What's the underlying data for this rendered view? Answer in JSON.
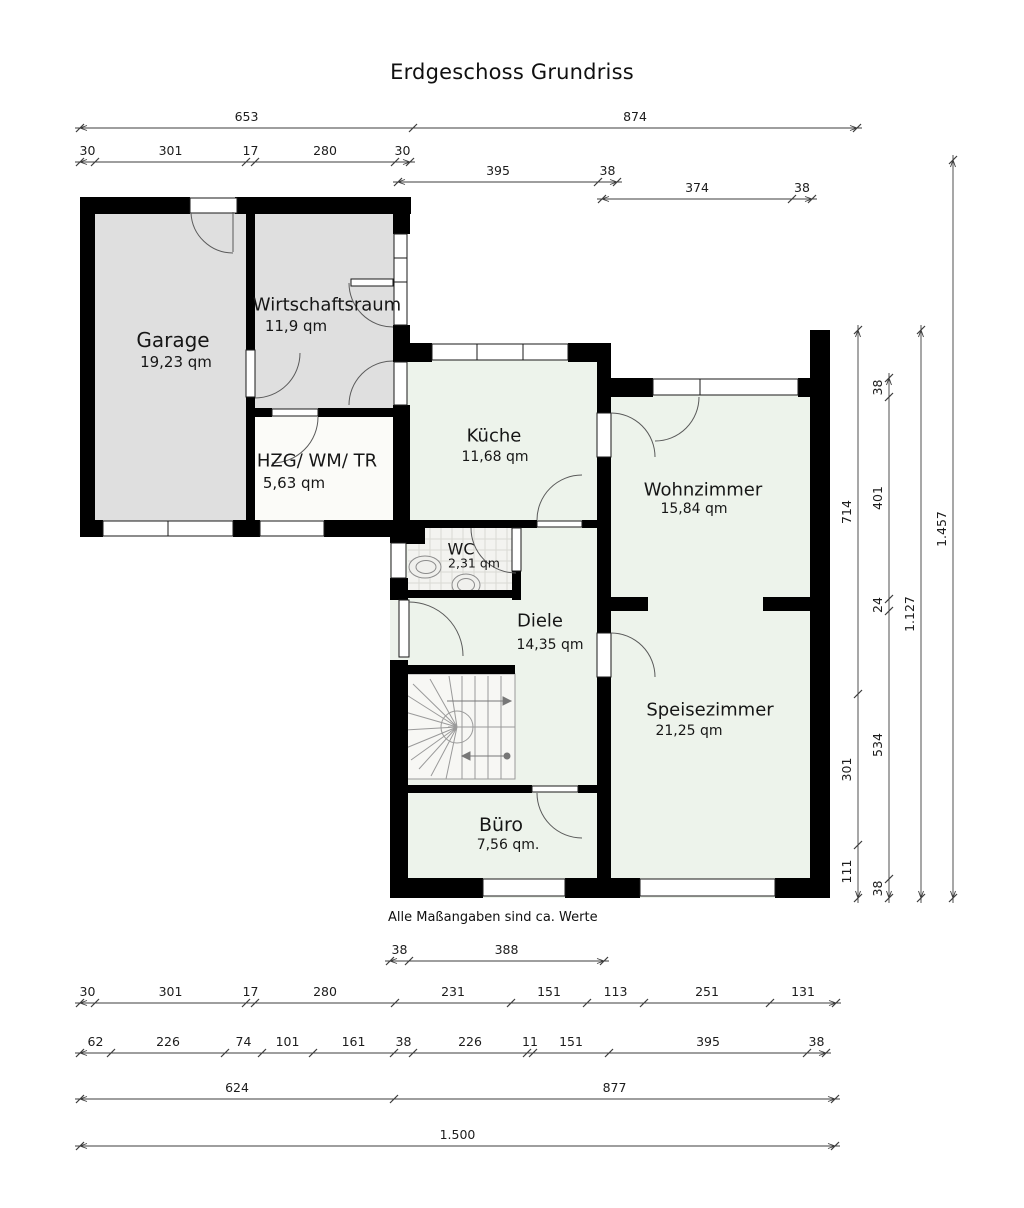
{
  "title": "Erdgeschoss Grundriss",
  "note": "Alle Maßangaben sind ca. Werte",
  "colors": {
    "wall": "#000000",
    "room_green": "#edf3eb",
    "room_gray": "#dfdfdf",
    "room_white": "#fbfbf8",
    "wc_tile": "#f3f3f0",
    "dim_line": "#3c3c3c",
    "text": "#161616"
  },
  "rooms": [
    {
      "id": "garage",
      "name": "Garage",
      "area": "19,23 qm",
      "cx": 173,
      "cy": 340,
      "acx": 176,
      "acy": 362,
      "nfs": 20,
      "afs": 15
    },
    {
      "id": "wirtschaftsraum",
      "name": "Wirtschaftsraum",
      "area": "11,9 qm",
      "cx": 327,
      "cy": 305,
      "acx": 296,
      "acy": 326,
      "nfs": 18,
      "afs": 15
    },
    {
      "id": "hzg",
      "name": "HZG/ WM/ TR",
      "area": "5,63 qm",
      "cx": 317,
      "cy": 461,
      "acx": 294,
      "acy": 483,
      "nfs": 18,
      "afs": 15
    },
    {
      "id": "kueche",
      "name": "Küche",
      "area": "11,68 qm",
      "cx": 494,
      "cy": 436,
      "acx": 495,
      "acy": 457,
      "nfs": 18,
      "afs": 14
    },
    {
      "id": "wohnzimmer",
      "name": "Wohnzimmer",
      "area": "15,84 qm",
      "cx": 703,
      "cy": 490,
      "acx": 694,
      "acy": 509,
      "nfs": 18,
      "afs": 14
    },
    {
      "id": "wc",
      "name": "WC",
      "area": "2,31 qm",
      "cx": 461,
      "cy": 549,
      "acx": 474,
      "acy": 563,
      "nfs": 16,
      "afs": 12.5
    },
    {
      "id": "diele",
      "name": "Diele",
      "area": "14,35 qm",
      "cx": 540,
      "cy": 621,
      "acx": 550,
      "acy": 645,
      "nfs": 18,
      "afs": 14
    },
    {
      "id": "speisezimmer",
      "name": "Speisezimmer",
      "area": "21,25 qm",
      "cx": 710,
      "cy": 710,
      "acx": 689,
      "acy": 731,
      "nfs": 18,
      "afs": 14
    },
    {
      "id": "buero",
      "name": "Büro",
      "area": "7,56 qm.",
      "cx": 501,
      "cy": 825,
      "acx": 508,
      "acy": 845,
      "nfs": 19,
      "afs": 14
    }
  ],
  "dimensions": {
    "horizontal_rows": [
      {
        "y": 128,
        "ticks": [
          80,
          413,
          857
        ],
        "labels": [
          "653",
          "874"
        ]
      },
      {
        "y": 162,
        "ticks": [
          80,
          95,
          246,
          255,
          395,
          410
        ],
        "labels": [
          "30",
          "301",
          "17",
          "280",
          "30"
        ]
      },
      {
        "y": 182,
        "ticks": [
          398,
          598,
          617
        ],
        "labels": [
          "395",
          "38"
        ]
      },
      {
        "y": 199,
        "ticks": [
          602,
          792,
          812
        ],
        "labels": [
          "374",
          "38"
        ]
      },
      {
        "y": 961,
        "ticks": [
          390,
          409,
          604
        ],
        "labels": [
          "38",
          "388"
        ]
      },
      {
        "y": 1003,
        "ticks": [
          80,
          95,
          246,
          255,
          395,
          511,
          587,
          644,
          770,
          836
        ],
        "labels": [
          "30",
          "301",
          "17",
          "280",
          "231",
          "151",
          "113",
          "251",
          "131"
        ]
      },
      {
        "y": 1053,
        "ticks": [
          80,
          111,
          225,
          262,
          313,
          394,
          413,
          527,
          533,
          609,
          807,
          826
        ],
        "labels": [
          "62",
          "226",
          "74",
          "101",
          "161",
          "38",
          "226",
          "11",
          "151",
          "395",
          "38"
        ]
      },
      {
        "y": 1099,
        "ticks": [
          80,
          394,
          835
        ],
        "labels": [
          "624",
          "877"
        ]
      },
      {
        "y": 1146,
        "ticks": [
          80,
          835
        ],
        "labels": [
          "1.500"
        ]
      }
    ],
    "vertical_cols": [
      {
        "x": 858,
        "ticks": [
          330,
          694,
          845,
          898
        ],
        "labels": [
          "714",
          "301",
          "111"
        ]
      },
      {
        "x": 889,
        "ticks": [
          378,
          397,
          599,
          611,
          879,
          898
        ],
        "labels": [
          "38",
          "401",
          "24",
          "534",
          "38"
        ]
      },
      {
        "x": 921,
        "ticks": [
          330,
          898
        ],
        "labels": [
          "1.127"
        ]
      },
      {
        "x": 953,
        "ticks": [
          160,
          898
        ],
        "labels": [
          "1.457"
        ]
      }
    ]
  }
}
